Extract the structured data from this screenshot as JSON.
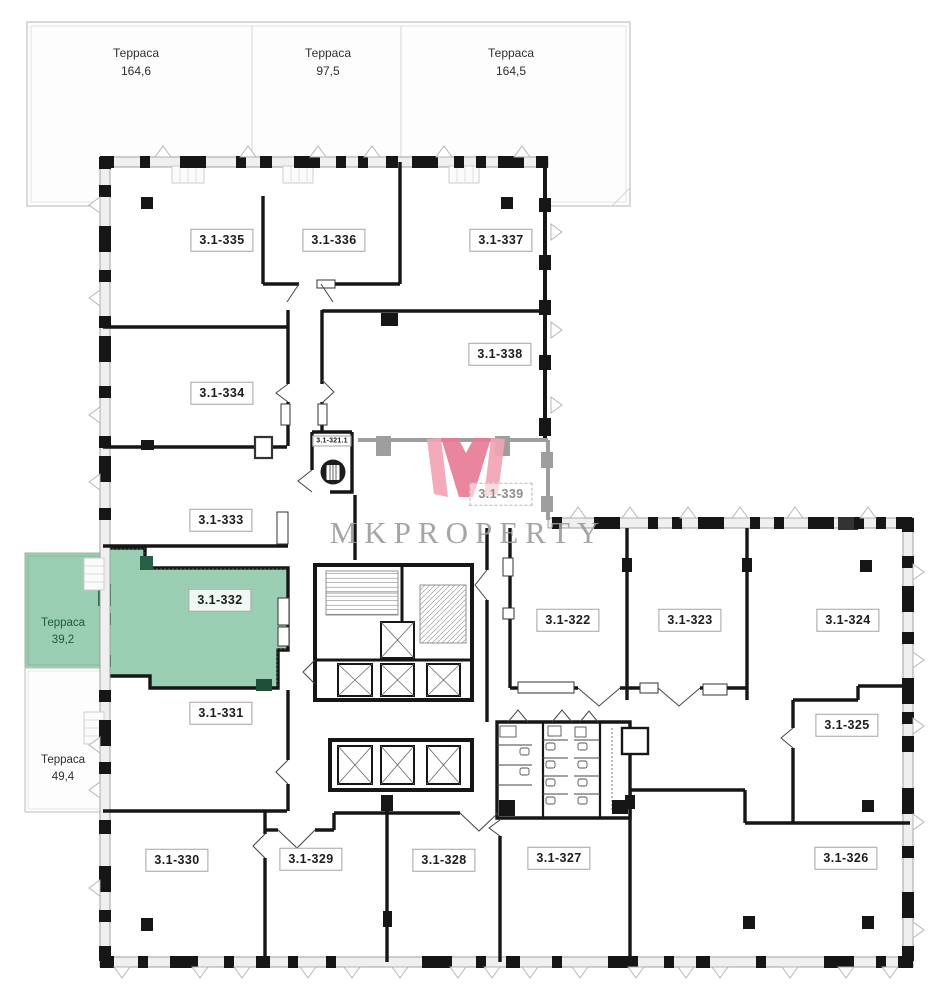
{
  "watermark": {
    "monogram": "M",
    "text": "MKPROPERTY"
  },
  "terraces": [
    {
      "name": "Терраса",
      "area": "164,6"
    },
    {
      "name": "Терраса",
      "area": "97,5"
    },
    {
      "name": "Терраса",
      "area": "164,5"
    },
    {
      "name": "Терраса",
      "area": "39,2"
    },
    {
      "name": "Терраса",
      "area": "49,4"
    }
  ],
  "units": [
    {
      "id": "3.1-335"
    },
    {
      "id": "3.1-336"
    },
    {
      "id": "3.1-337"
    },
    {
      "id": "3.1-338"
    },
    {
      "id": "3.1-334"
    },
    {
      "id": "3.1-333"
    },
    {
      "id": "3.1-339"
    },
    {
      "id": "3.1-332"
    },
    {
      "id": "3.1-331"
    },
    {
      "id": "3.1-330"
    },
    {
      "id": "3.1-329"
    },
    {
      "id": "3.1-328"
    },
    {
      "id": "3.1-327"
    },
    {
      "id": "3.1-326"
    },
    {
      "id": "3.1-325"
    },
    {
      "id": "3.1-324"
    },
    {
      "id": "3.1-323"
    },
    {
      "id": "3.1-322"
    },
    {
      "id": "3.1-321.1"
    }
  ],
  "highlight": {
    "unit": "3.1-332",
    "terrace_area": "39,2",
    "fill_color": "#9bceb2",
    "accent_color": "#2f7050"
  },
  "colors": {
    "wall": "#161616",
    "window_wall": "#999999",
    "gray_wall": "#9e9e9e",
    "terrace_line": "#c2c2c2",
    "logo_pink": "#e87b95",
    "logo_pink_light": "#f2a3b4",
    "logo_text": "#9c9c9c",
    "muted_label": "#8d8d8d"
  }
}
